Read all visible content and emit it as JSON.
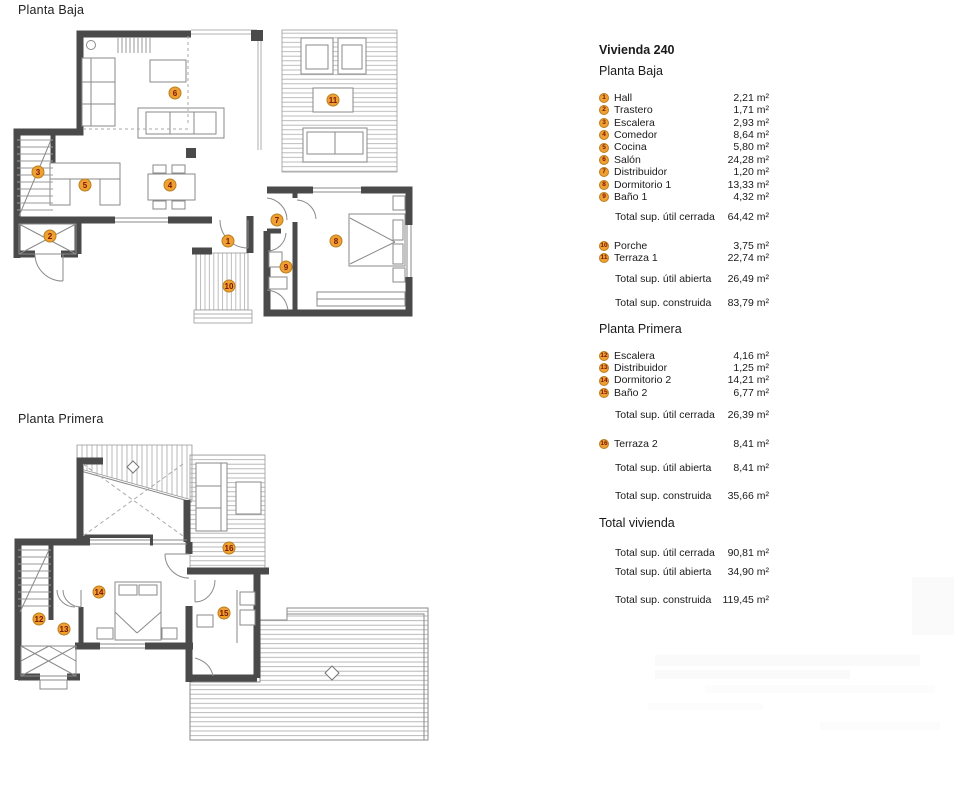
{
  "plans": {
    "baja_title": "Planta Baja",
    "primera_title": "Planta Primera"
  },
  "legend": {
    "title": "Vivienda 240",
    "pb_heading": "Planta Baja",
    "pb_rooms": [
      {
        "n": "1",
        "label": "Hall",
        "area": "2,21 m²"
      },
      {
        "n": "2",
        "label": "Trastero",
        "area": "1,71 m²"
      },
      {
        "n": "3",
        "label": "Escalera",
        "area": "2,93 m²"
      },
      {
        "n": "4",
        "label": "Comedor",
        "area": "8,64 m²"
      },
      {
        "n": "5",
        "label": "Cocina",
        "area": "5,80 m²"
      },
      {
        "n": "6",
        "label": "Salón",
        "area": "24,28 m²"
      },
      {
        "n": "7",
        "label": "Distribuidor",
        "area": "1,20 m²"
      },
      {
        "n": "8",
        "label": "Dormitorio 1",
        "area": "13,33 m²"
      },
      {
        "n": "9",
        "label": "Baño 1",
        "area": "4,32 m²"
      }
    ],
    "pb_total_cerrada_label": "Total sup. útil cerrada",
    "pb_total_cerrada_value": "64,42 m²",
    "pb_open_rooms": [
      {
        "n": "10",
        "label": "Porche",
        "area": "3,75 m²"
      },
      {
        "n": "11",
        "label": "Terraza 1",
        "area": "22,74 m²"
      }
    ],
    "pb_total_abierta_label": "Total sup. útil abierta",
    "pb_total_abierta_value": "26,49 m²",
    "pb_total_construida_label": "Total sup. construida",
    "pb_total_construida_value": "83,79 m²",
    "pp_heading": "Planta Primera",
    "pp_rooms": [
      {
        "n": "12",
        "label": "Escalera",
        "area": "4,16 m²"
      },
      {
        "n": "13",
        "label": "Distribuidor",
        "area": "1,25 m²"
      },
      {
        "n": "14",
        "label": "Dormitorio 2",
        "area": "14,21 m²"
      },
      {
        "n": "15",
        "label": "Baño 2",
        "area": "6,77 m²"
      }
    ],
    "pp_total_cerrada_label": "Total sup. útil cerrada",
    "pp_total_cerrada_value": "26,39 m²",
    "pp_open_rooms": [
      {
        "n": "16",
        "label": "Terraza 2",
        "area": "8,41 m²"
      }
    ],
    "pp_total_abierta_label": "Total sup. útil abierta",
    "pp_total_abierta_value": "8,41 m²",
    "pp_total_construida_label": "Total sup. construida",
    "pp_total_construida_value": "35,66 m²",
    "tv_heading": "Total vivienda",
    "tv_total_cerrada_label": "Total sup. útil cerrada",
    "tv_total_cerrada_value": "90,81 m²",
    "tv_total_abierta_label": "Total sup. útil abierta",
    "tv_total_abierta_value": "34,90 m²",
    "tv_total_construida_label": "Total sup. construida",
    "tv_total_construida_value": "119,45 m²"
  },
  "colors": {
    "wall": "#4a4a4a",
    "badge_fill": "#efa033",
    "badge_border": "#b97f1d",
    "badge_text": "#7a1507"
  }
}
